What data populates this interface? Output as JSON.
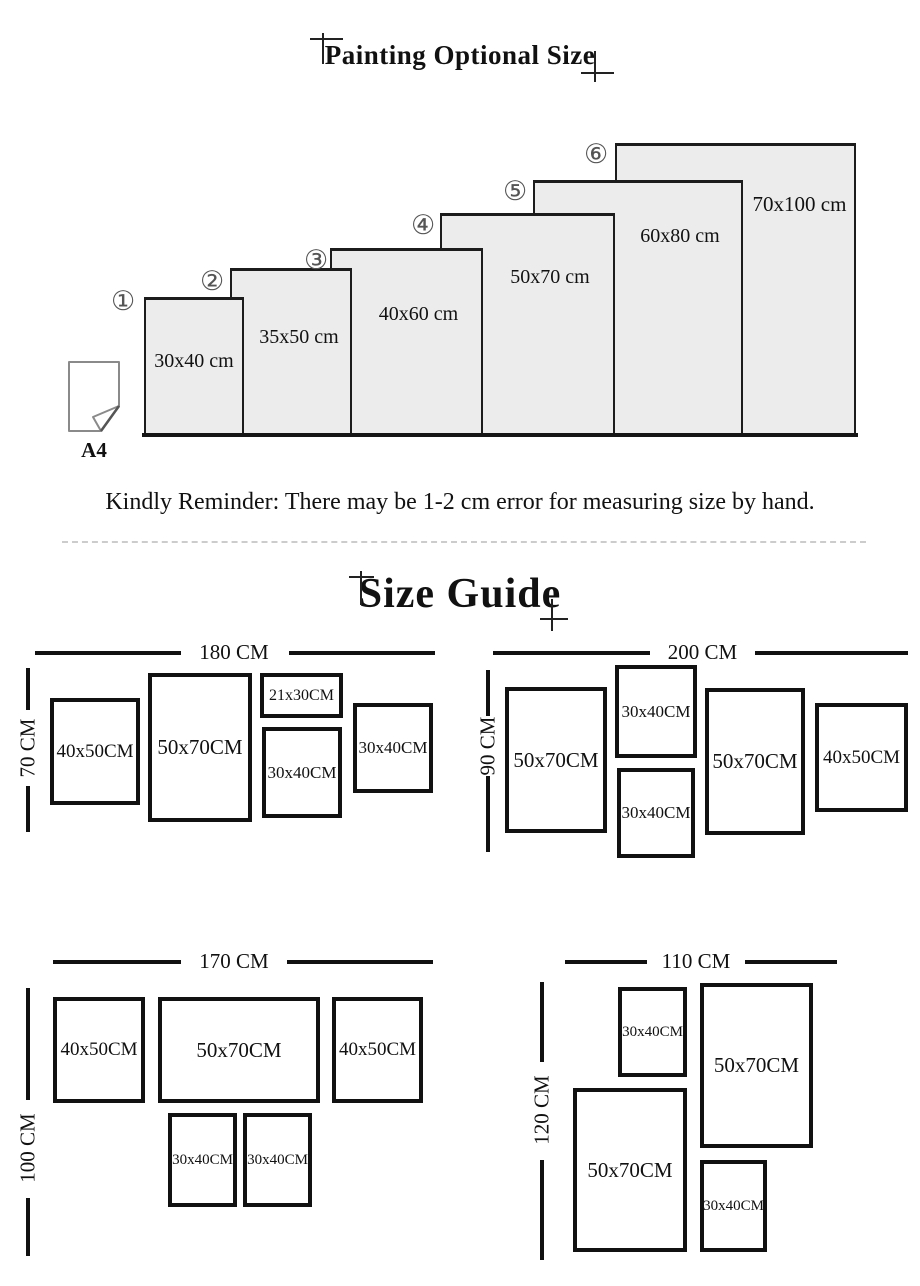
{
  "page": {
    "title": "Painting Optional Size",
    "reminder": "Kindly Reminder: There may be 1-2 cm error for measuring size by hand."
  },
  "staircase": {
    "a4_label": "A4",
    "items": [
      {
        "num": "①",
        "label": "30x40 cm"
      },
      {
        "num": "②",
        "label": "35x50 cm"
      },
      {
        "num": "③",
        "label": "40x60 cm"
      },
      {
        "num": "④",
        "label": "50x70 cm"
      },
      {
        "num": "⑤",
        "label": "60x80 cm"
      },
      {
        "num": "⑥",
        "label": "70x100 cm"
      }
    ]
  },
  "size_guide": {
    "title": "Size Guide",
    "diagrams": [
      {
        "width_label": "180 CM",
        "height_label": "70 CM",
        "frames": [
          {
            "label": "40x50CM"
          },
          {
            "label": "50x70CM"
          },
          {
            "label": "21x30CM"
          },
          {
            "label": "30x40CM"
          },
          {
            "label": "30x40CM"
          }
        ]
      },
      {
        "width_label": "200 CM",
        "height_label": "90 CM",
        "frames": [
          {
            "label": "50x70CM"
          },
          {
            "label": "30x40CM"
          },
          {
            "label": "30x40CM"
          },
          {
            "label": "50x70CM"
          },
          {
            "label": "40x50CM"
          }
        ]
      },
      {
        "width_label": "170 CM",
        "height_label": "100 CM",
        "frames": [
          {
            "label": "40x50CM"
          },
          {
            "label": "50x70CM"
          },
          {
            "label": "40x50CM"
          },
          {
            "label": "30x40CM"
          },
          {
            "label": "30x40CM"
          }
        ]
      },
      {
        "width_label": "110 CM",
        "height_label": "120 CM",
        "frames": [
          {
            "label": "30x40CM"
          },
          {
            "label": "50x70CM"
          },
          {
            "label": "50x70CM"
          },
          {
            "label": "30x40CM"
          }
        ]
      }
    ]
  },
  "colors": {
    "background": "#ffffff",
    "line_black": "#111111",
    "staircase_fill": "#ececec",
    "staircase_border": "#1c1c1c",
    "circle_gray": "#555555",
    "divider_gray": "#cccccc",
    "a4_outline": "#8a8a8a"
  }
}
